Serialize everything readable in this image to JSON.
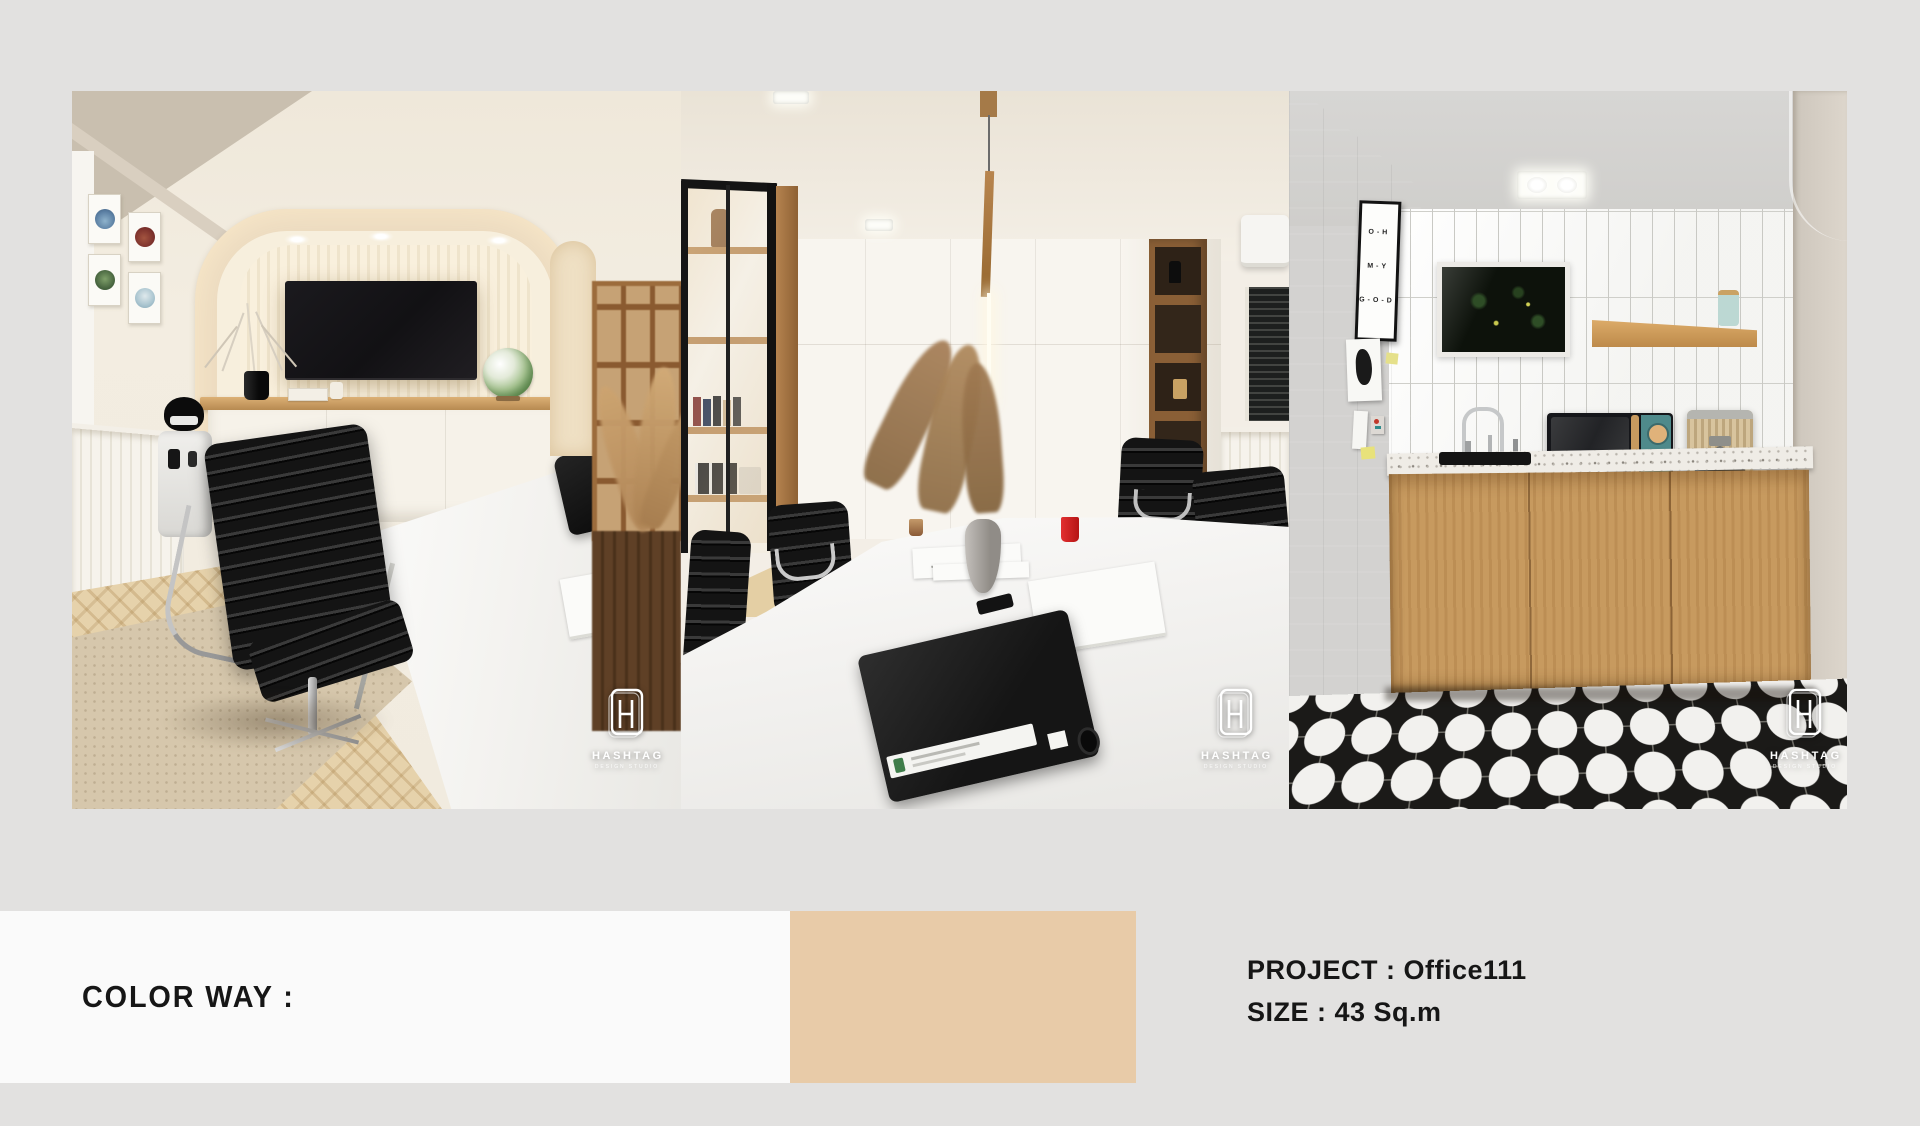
{
  "canvas": {
    "background": "#E2E1E0"
  },
  "branding": {
    "name": "HASHTAG",
    "tagline": "DESIGN STUDIO"
  },
  "footer": {
    "color_way_label": "COLOR WAY :",
    "project": "PROJECT : Office111",
    "size": "SIZE : 43 Sq.m",
    "swatches": [
      {
        "name": "white",
        "hex": "#FAFAFA",
        "css": "background:#fafafa"
      },
      {
        "name": "tan",
        "hex": "#E8CBA8",
        "css": "background:#e8cba8"
      }
    ]
  },
  "photos": [
    {
      "alt": "private office with arched TV niche, black ribbed chair and white desk"
    },
    {
      "alt": "meeting room with white conference table, black chairs, glass partition and pendant light"
    },
    {
      "alt": "kitchenette with concrete wall, white vertical tiles, oak cabinets and black-white star tile floor",
      "poster_lines": [
        "O-H",
        "M-Y",
        "G-O-D"
      ]
    }
  ]
}
